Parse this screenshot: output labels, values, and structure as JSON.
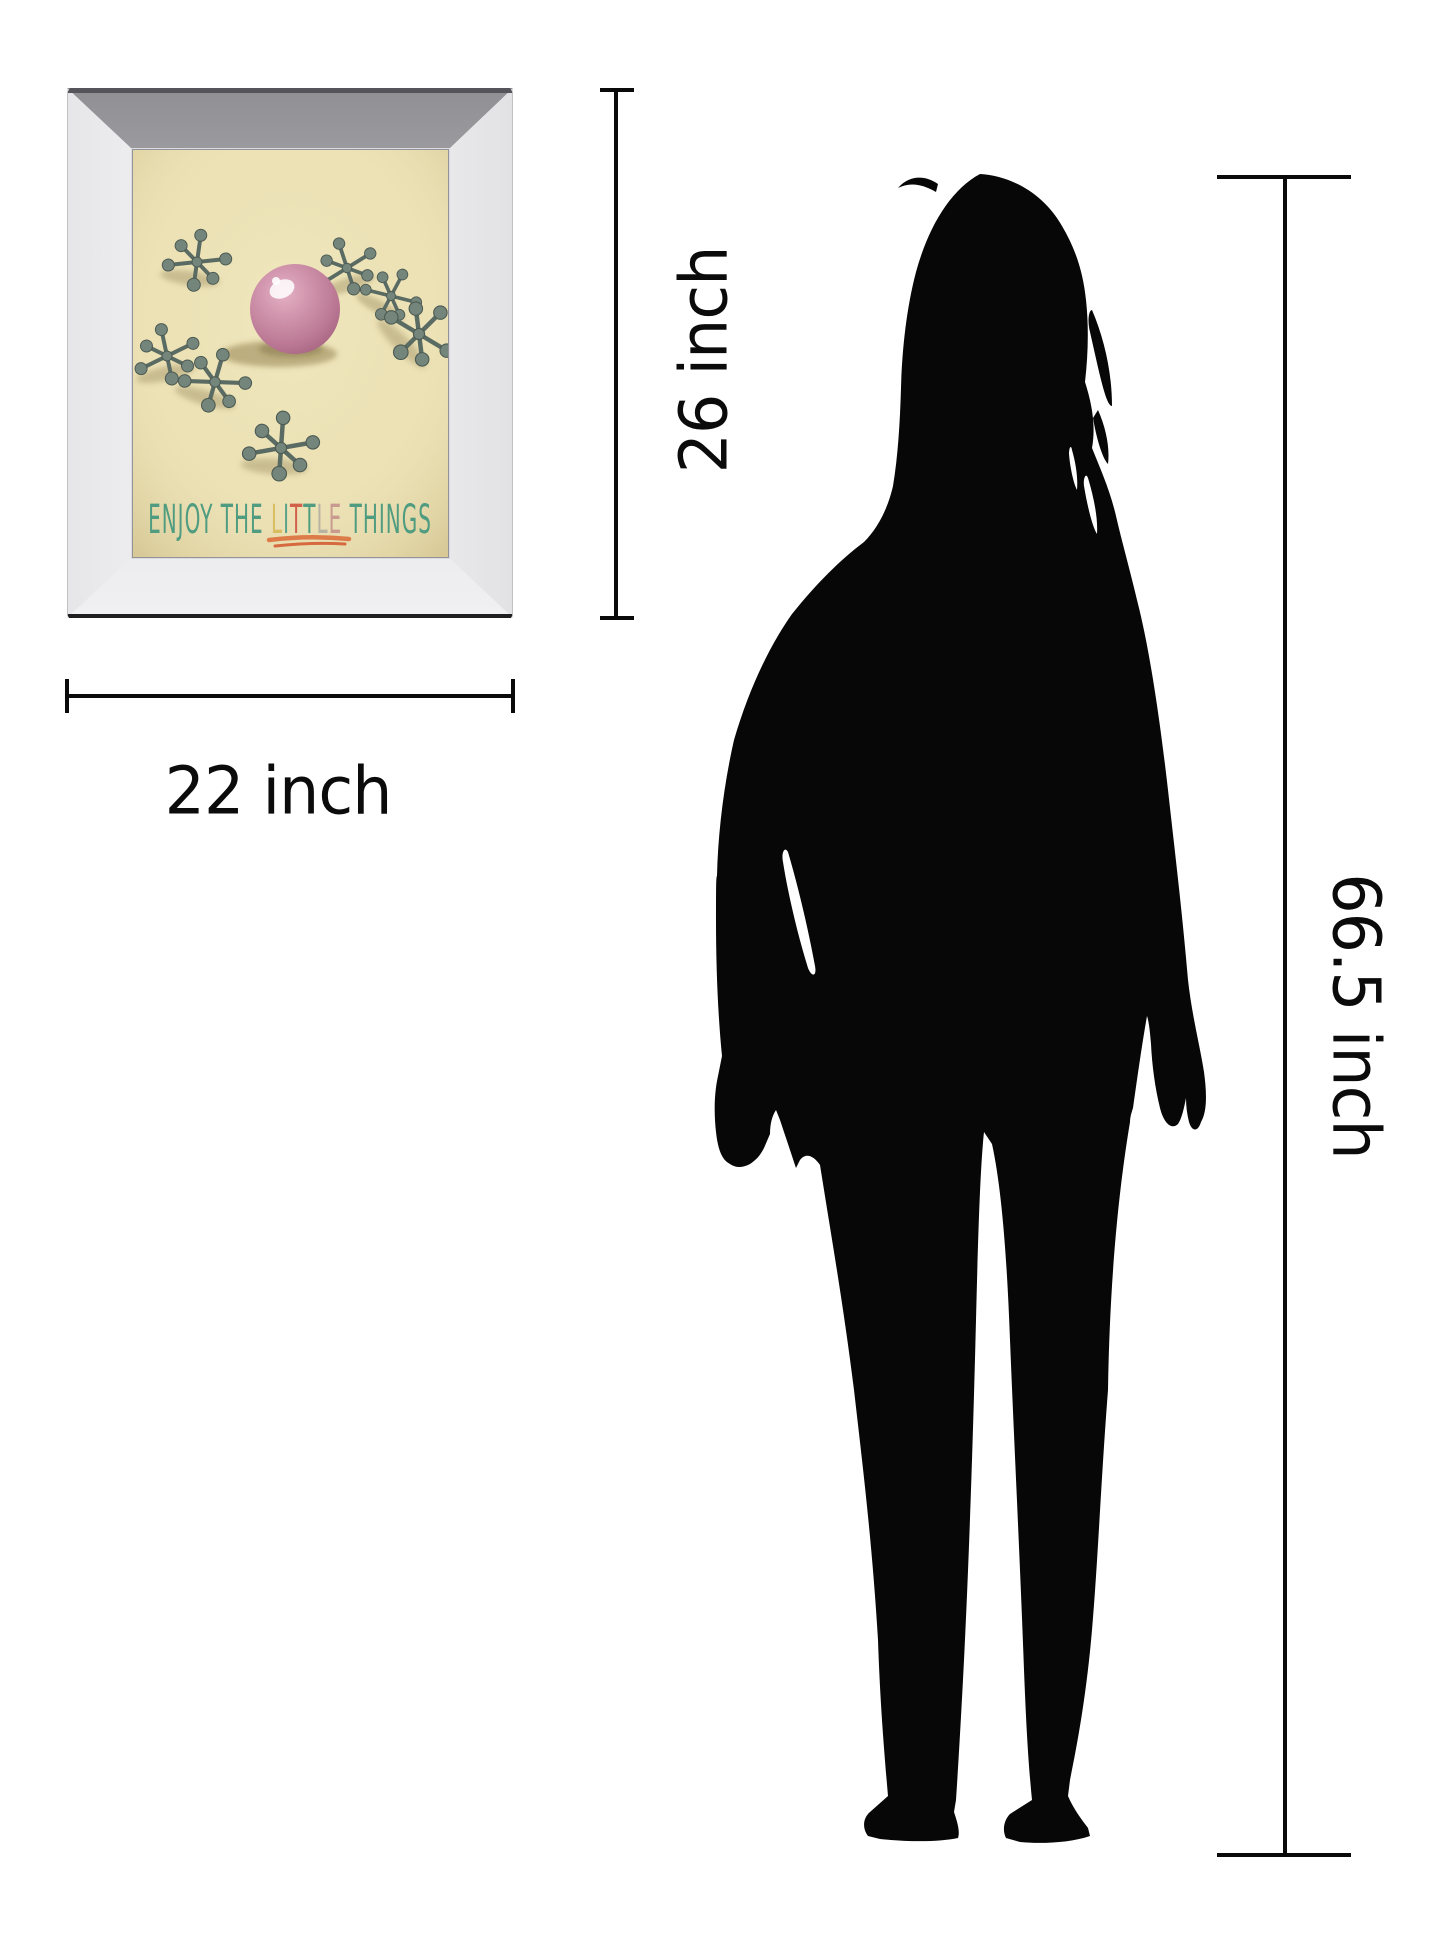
{
  "meta": {
    "description": "Product size-comparison image: mirror-framed wall art next to a woman silhouette with dimensions"
  },
  "artwork": {
    "caption_segments": [
      {
        "text": "ENJOY THE ",
        "color": "#4f9c80"
      },
      {
        "text": "L",
        "color": "#d8bd62"
      },
      {
        "text": "I",
        "color": "#57a289"
      },
      {
        "text": "T",
        "color": "#d2604b"
      },
      {
        "text": "T",
        "color": "#4f9c80"
      },
      {
        "text": "L",
        "color": "#b9b3a4"
      },
      {
        "text": "E",
        "color": "#c99b90"
      },
      {
        "text": " THINGS",
        "color": "#4f9c80"
      }
    ],
    "underline_color": "#dd7c49",
    "background_color": "#ece2b6",
    "ball_color": "#c990a9",
    "jack_color": "#74857c"
  },
  "measurements": {
    "frame_width": {
      "label": "22 inch",
      "value": 22,
      "unit": "inch"
    },
    "frame_height": {
      "label": "26 inch",
      "value": 26,
      "unit": "inch"
    },
    "person_height": {
      "label": "66.5 inch",
      "value": 66.5,
      "unit": "inch"
    }
  },
  "colors": {
    "dimension_line": "#0a0a0a",
    "silhouette": "#070707",
    "background": "#ffffff"
  }
}
